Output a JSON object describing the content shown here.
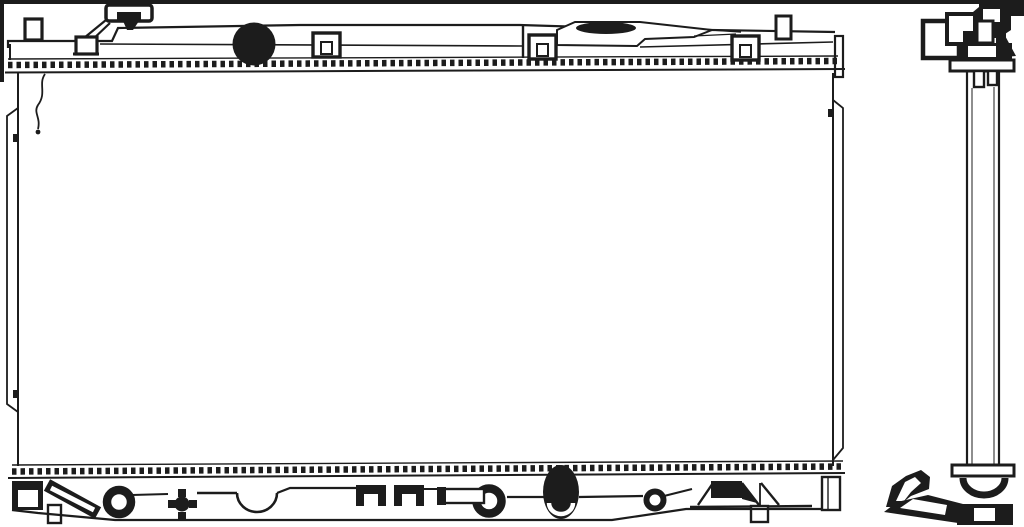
{
  "canvas": {
    "width": 1024,
    "height": 527,
    "background_color": "#ffffff",
    "ink_color": "#1c1c1c"
  },
  "figure": {
    "kind": "technical line drawing",
    "subject": "automotive radiator",
    "views": [
      {
        "id": "front",
        "label": "radiator-front-view"
      },
      {
        "id": "side",
        "label": "radiator-side-view"
      }
    ],
    "parts": [
      "radiator-cap",
      "filler-neck-hole",
      "inlet-pipe",
      "mounting-clips",
      "core",
      "top-tank",
      "bottom-tank",
      "drain-valve",
      "outlet-pipe",
      "ring-fittings",
      "mounting-bracket",
      "side-column",
      "lower-foot-bracket"
    ]
  }
}
